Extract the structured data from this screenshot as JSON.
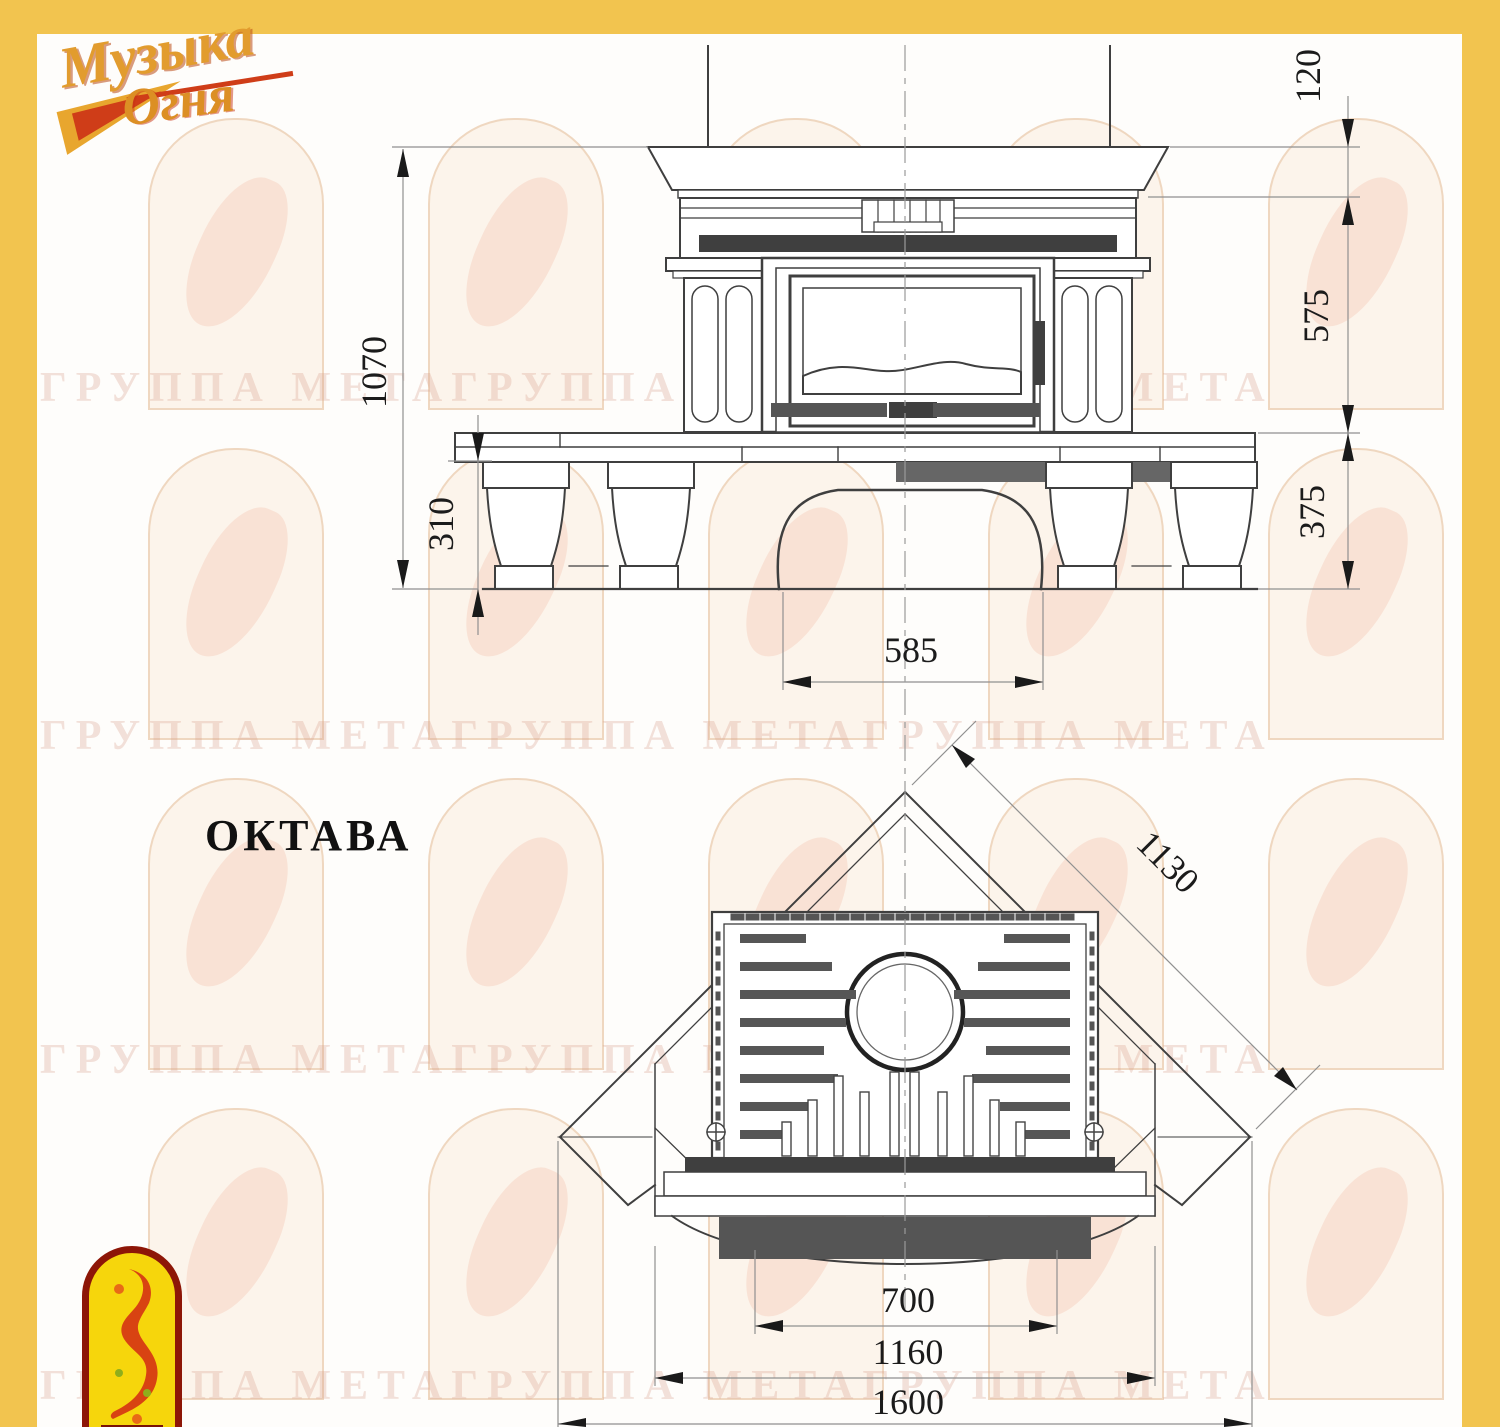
{
  "colors": {
    "border_gold": "#f2c44f",
    "line": "#3f3f3f",
    "watermark": "#d79e8c"
  },
  "logo": {
    "word1": "Музыка",
    "word2": "Огня"
  },
  "title": "ОКТАВА",
  "watermark_text": "ГРУППА МЕТАГРУППА МЕТАГРУППА МЕТА",
  "front_view": {
    "dimensions": {
      "total_height": "1070",
      "mantel_thickness": "120",
      "middle_height": "575",
      "base_height": "375",
      "plinth_height": "310",
      "arch_width": "585"
    }
  },
  "plan_view": {
    "dimensions": {
      "diagonal_side": "1130",
      "firebox_width": "700",
      "front_width": "1160",
      "overall_width": "1600"
    }
  }
}
